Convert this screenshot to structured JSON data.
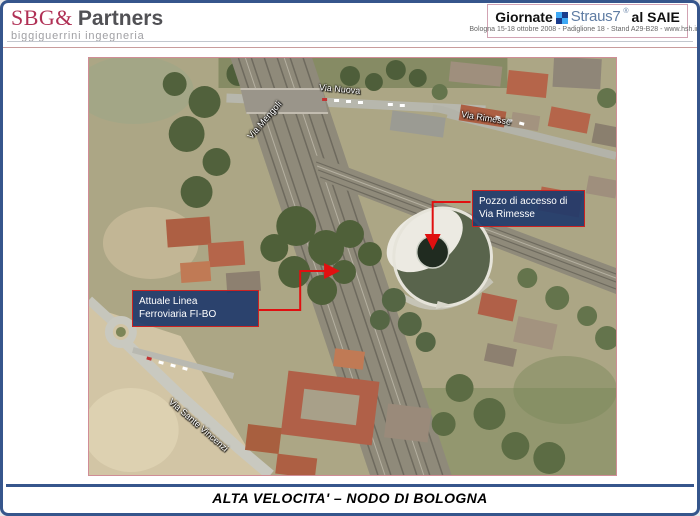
{
  "header": {
    "sbg_partners": {
      "accent": "SBG&",
      "rest": "Partners",
      "subtitle": "biggiguerrini ingegneria"
    },
    "event_badge": {
      "word1": "Giornate",
      "brand": "Straus7",
      "reg_mark": "®",
      "word2": "al SAIE",
      "details": "Bologna 15-18 ottobre 2008 - Padiglione 18 - Stand A29-B28 - www.hsh.info"
    }
  },
  "map": {
    "street_labels": [
      {
        "text": "Via Nuova"
      },
      {
        "text": "Via Mengoli"
      },
      {
        "text": "Via Rimesse"
      },
      {
        "text": "Via Sante Vincenzi"
      }
    ],
    "callouts": [
      {
        "line1": "Pozzo di accesso di",
        "line2": "Via Rimesse"
      },
      {
        "line1": "Attuale Linea",
        "line2": "Ferroviaria FI-BO"
      }
    ]
  },
  "footer": {
    "title": "ALTA VELOCITA' – NODO DI BOLOGNA"
  },
  "colors": {
    "slide_border": "#36568c",
    "map_border": "#d08d96",
    "callout_bg": "#20396b",
    "callout_border": "#cc2222",
    "arrow_red": "#e01010",
    "sbg_accent": "#b03055",
    "event_border": "#d2a3b3",
    "straus_blue": "#5f7ca3"
  }
}
